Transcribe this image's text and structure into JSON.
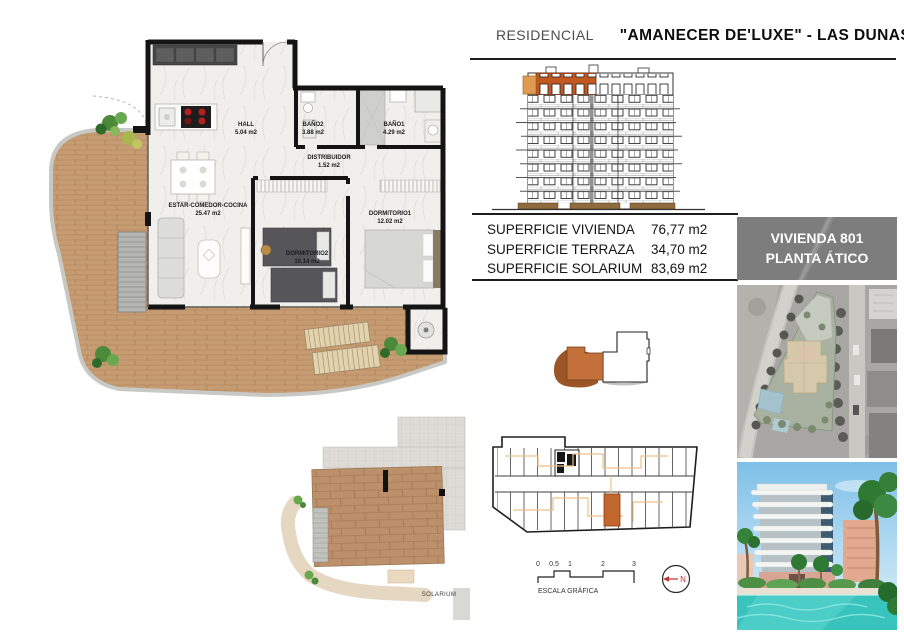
{
  "header": {
    "prefix": "RESIDENCIAL",
    "title": "\"AMANECER DE'LUXE\" - LAS DUNAS\""
  },
  "plan": {
    "rooms": {
      "hall": {
        "name": "HALL",
        "area": "5.04 m2"
      },
      "bano2": {
        "name": "BAÑO2",
        "area": "3.88 m2"
      },
      "bano1": {
        "name": "BAÑO1",
        "area": "4.29 m2"
      },
      "distribuidor": {
        "name": "DISTRIBUIDOR",
        "area": "1.52 m2"
      },
      "estar": {
        "name": "ESTAR-COMEDOR-COCINA",
        "area": "25.47 m2"
      },
      "dormitorio2": {
        "name": "DORMITORIO2",
        "area": "10.14 m2"
      },
      "dormitorio1": {
        "name": "DORMITORIO1",
        "area": "12.02 m2"
      }
    },
    "solarium_label": "SOLARIUM"
  },
  "summary": {
    "rows": [
      {
        "label": "SUPERFICIE VIVIENDA",
        "value": "76,77 m2"
      },
      {
        "label": "SUPERFICIE TERRAZA",
        "value": "34,70 m2"
      },
      {
        "label": "SUPERFICIE SOLARIUM",
        "value": "83,69 m2"
      }
    ]
  },
  "badge": {
    "line1": "VIVIENDA 801",
    "line2": "PLANTA ÁTICO"
  },
  "scalebar": {
    "ticks": [
      "0",
      "0.5",
      "1",
      "2",
      "3"
    ],
    "label": "ESCALA GRÁFICA"
  },
  "compass": {
    "label": "N"
  },
  "colors": {
    "highlight_orange": "#c2571f",
    "badge_gray": "#7d7d7d",
    "terrace_wood": "#c69c73",
    "pool_blue": "#38c4bd"
  }
}
